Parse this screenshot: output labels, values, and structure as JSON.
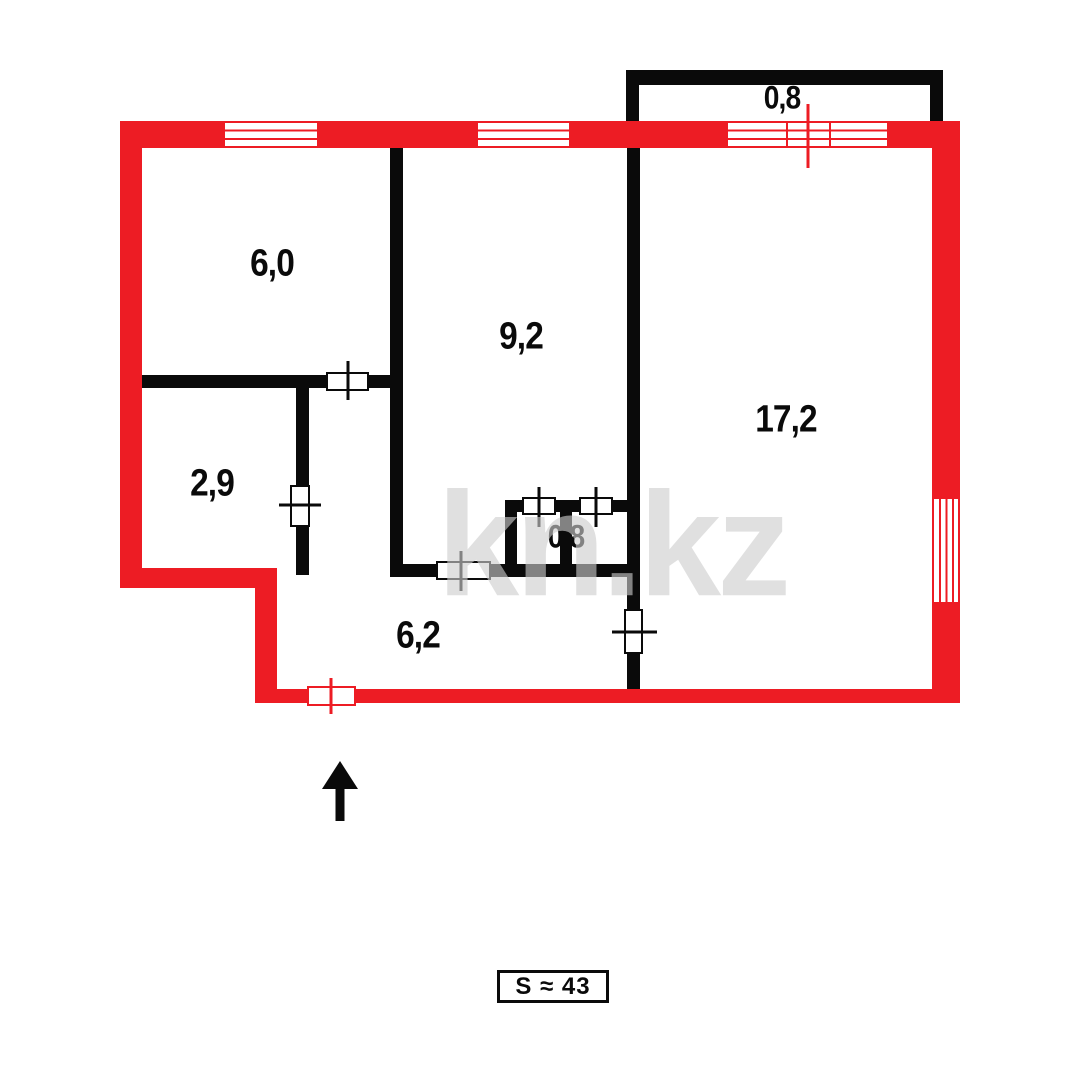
{
  "floorplan": {
    "watermark": "kn.kz",
    "total_area_label": "S ≈ 43",
    "rooms": {
      "room_top_left": "6,0",
      "room_middle": "9,2",
      "living_room": "17,2",
      "room_small_left": "2,9",
      "wc": "0,8",
      "hallway": "6,2",
      "balcony": "0,8"
    },
    "colors": {
      "exterior_wall": "#ED1C24",
      "interior_wall": "#0a0a0a",
      "watermark": "#CDCDCD",
      "background": "#FFFFFF"
    }
  }
}
